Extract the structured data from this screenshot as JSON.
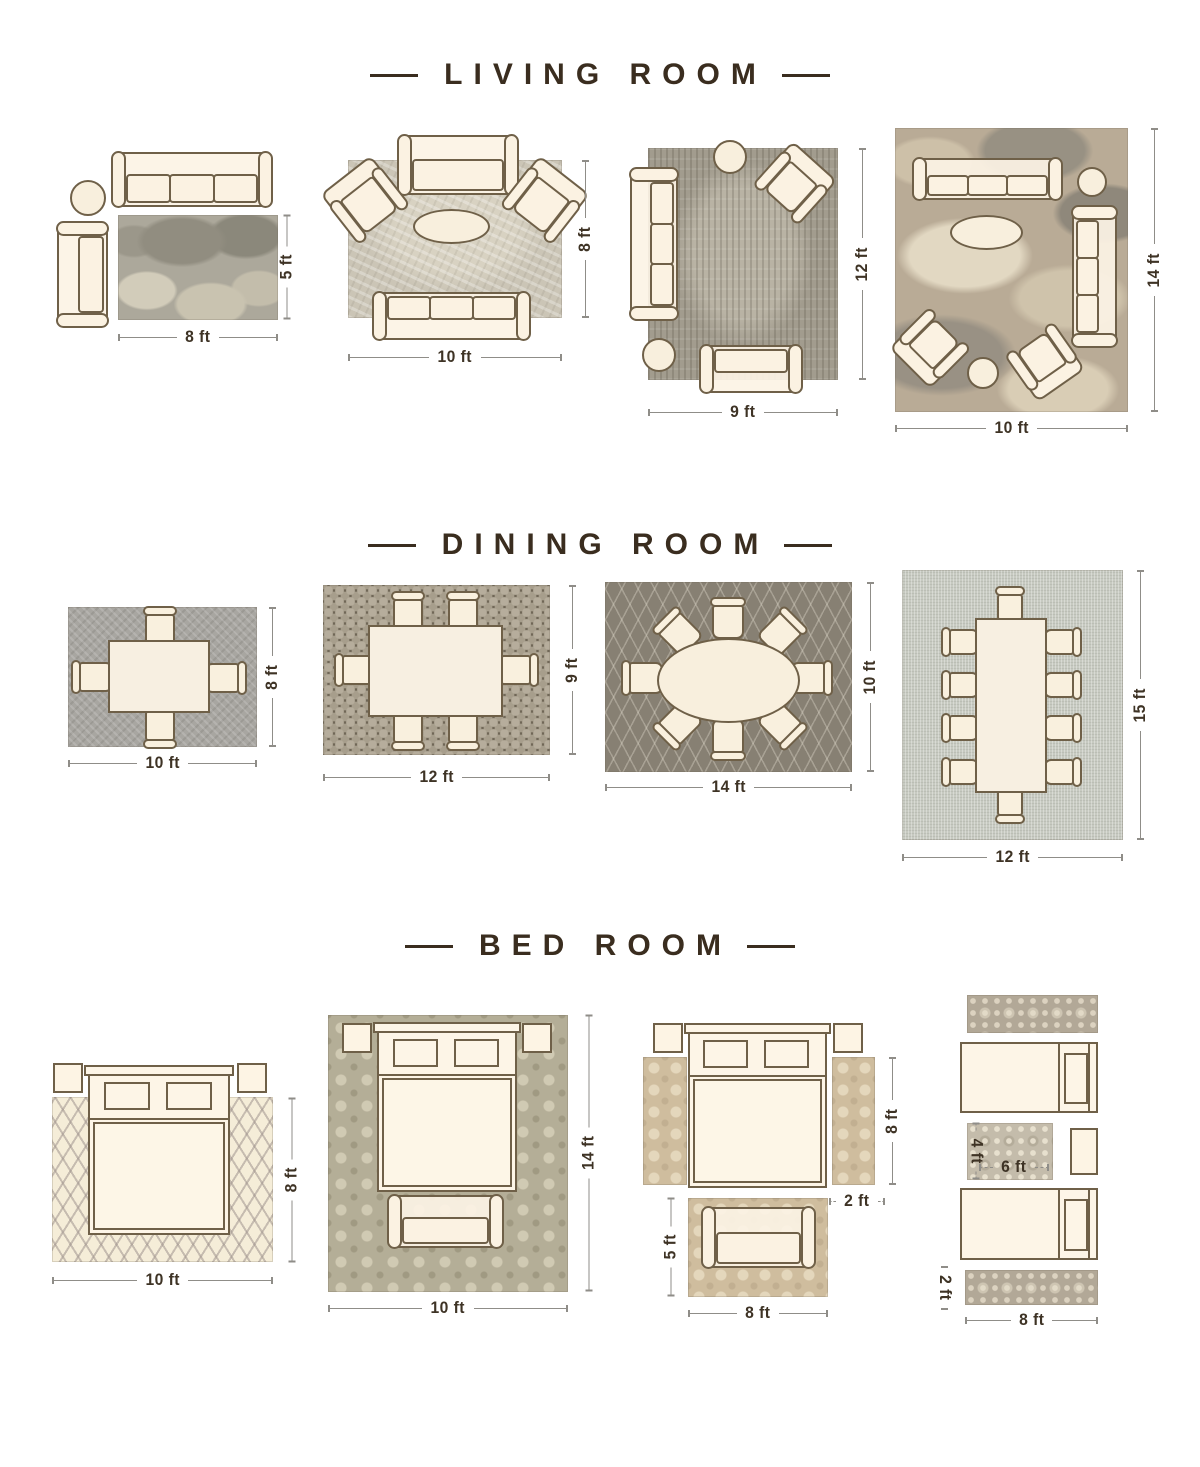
{
  "colors": {
    "title_text": "#3a2d1f",
    "dimension_text": "#3e3325",
    "dimension_line": "#8f8d88",
    "furniture_outline": "#6f6048",
    "furniture_fill": "#fbf2e2"
  },
  "sections": [
    {
      "title": "LIVING ROOM",
      "diagrams": [
        {
          "width": "8 ft",
          "height": "5 ft"
        },
        {
          "width": "10 ft",
          "height": "8 ft"
        },
        {
          "width": "9 ft",
          "height": "12 ft"
        },
        {
          "width": "10 ft",
          "height": "14 ft"
        }
      ]
    },
    {
      "title": "DINING ROOM",
      "diagrams": [
        {
          "width": "10 ft",
          "height": "8 ft"
        },
        {
          "width": "12 ft",
          "height": "9 ft"
        },
        {
          "width": "14 ft",
          "height": "10 ft"
        },
        {
          "width": "12 ft",
          "height": "15 ft"
        }
      ]
    },
    {
      "title": "BED ROOM",
      "diagrams": [
        {
          "width": "10 ft",
          "height": "8 ft"
        },
        {
          "width": "10 ft",
          "height": "14 ft"
        },
        {
          "runner_length": "8 ft",
          "runner_width": "2 ft",
          "foot_rug_height": "5 ft",
          "foot_rug_width": "8 ft"
        },
        {
          "accent_rug_height": "4 ft",
          "accent_rug_width": "6 ft",
          "runner_height": "2 ft",
          "runner_width": "8 ft"
        }
      ]
    }
  ]
}
